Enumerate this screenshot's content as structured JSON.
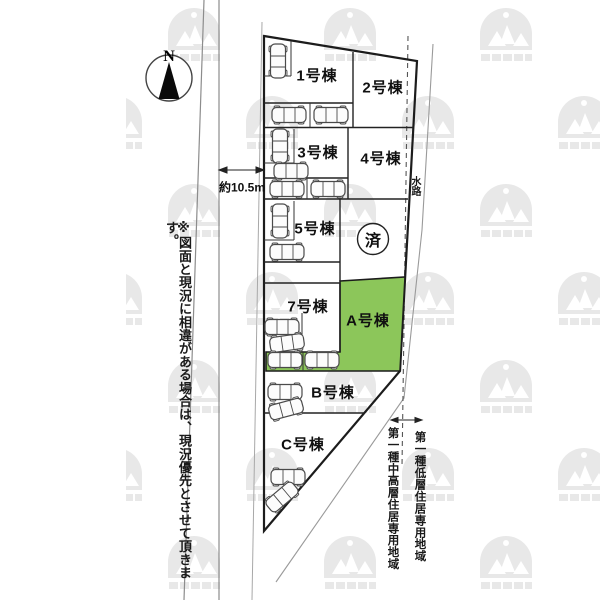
{
  "compass": {
    "label": "N"
  },
  "road": {
    "dimension_label": "約10.5m"
  },
  "note": {
    "text": "※図面と現況に相違がある場合は、現況優先とさせて頂きます。"
  },
  "waterway": {
    "label": "水路"
  },
  "zoning": {
    "left_label": "第一種中高層住居専用地域",
    "right_label": "第一種低層住居専用地域"
  },
  "plots": {
    "units": [
      {
        "label": "1号棟"
      },
      {
        "label": "2号棟"
      },
      {
        "label": "3号棟"
      },
      {
        "label": "4号棟"
      },
      {
        "label": "5号棟"
      },
      {
        "label": "7号棟"
      },
      {
        "label": "A号棟"
      },
      {
        "label": "B号棟"
      },
      {
        "label": "C号棟"
      }
    ],
    "sold": {
      "label": "済"
    },
    "highlighted_unit": "A号棟",
    "highlight_color": "#8cc65a"
  }
}
